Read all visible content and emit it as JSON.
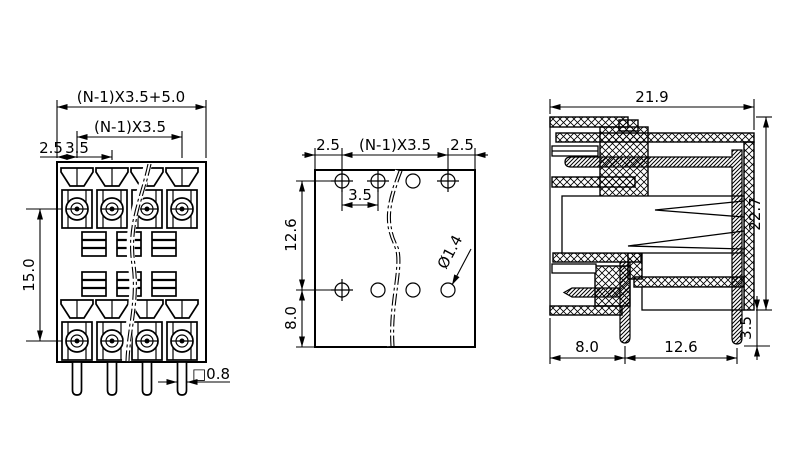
{
  "drawing": {
    "front_view": {
      "dim_overall_width": "(N-1)X3.5+5.0",
      "dim_pitch_span": "(N-1)X3.5",
      "dim_edge_offset": "2.5",
      "dim_pitch": "3.5",
      "dim_row_spacing": "15.0",
      "dim_pin_square": "□0.8"
    },
    "pcb_view": {
      "dim_left_margin": "2.5",
      "dim_pitch_span": "(N-1)X3.5",
      "dim_right_margin": "2.5",
      "dim_pitch": "3.5",
      "dim_row_spacing": "12.6",
      "dim_bottom_offset": "8.0",
      "dim_hole_diameter": "Ø1.4"
    },
    "side_view": {
      "dim_total_depth": "21.9",
      "dim_total_height": "22.7",
      "dim_pin_protrusion": "3.5",
      "dim_front_pin_offset": "8.0",
      "dim_pin_row_spacing": "12.6"
    }
  }
}
